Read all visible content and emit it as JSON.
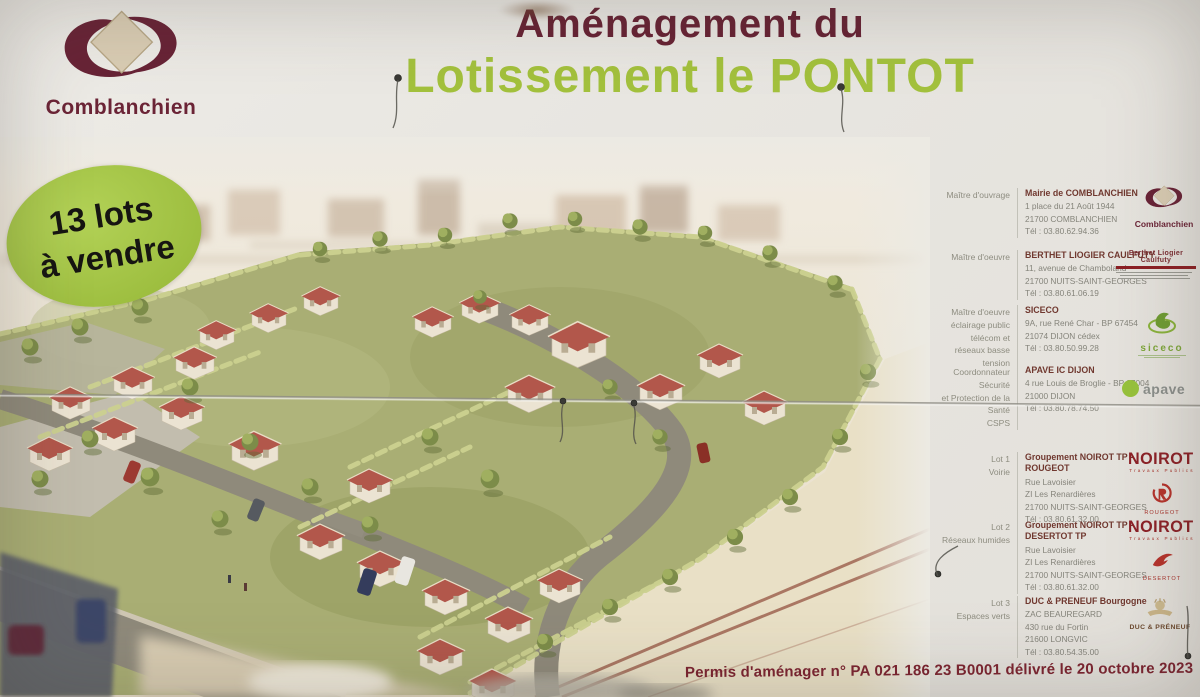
{
  "sign": {
    "title_line1": "Aménagement du",
    "title_line2": "Lotissement le PONTOT",
    "badge_line1": "13 lots",
    "badge_line2": "à vendre",
    "permit_line": "Permis d'aménager n° PA 021 186 23 B0001 délivré le 20 octobre 2023",
    "colors": {
      "title_maroon": "#672334",
      "title_green": "#a3c13d",
      "badge_green": "#a9c94e",
      "permit_red": "#7c2330",
      "noirot_red": "#8c2127",
      "siceco_green": "#7ea63a",
      "apave_green": "#97c23c"
    }
  },
  "logos": {
    "comblanchien": "Comblanchien",
    "comblanchien_small": "Comblanchien",
    "berthet": "Berthet Liogier Caulfuty",
    "siceco": "siceco",
    "apave": "apave",
    "noirot": "NOIROT",
    "noirot_sub": "Travaux Publics",
    "rougeot": "ROUGEOT",
    "desertot": "DESERTOT",
    "duc_preneuf": "DUC & PRÉNEUF"
  },
  "contacts": [
    {
      "role": "Maître d'ouvrage",
      "name": "Mairie de COMBLANCHIEN",
      "address": "1 place du 21 Août 1944\n21700 COMBLANCHIEN\nTél : 03.80.62.94.36"
    },
    {
      "role": "Maître d'oeuvre",
      "name": "BERTHET LIOGIER CAULFUTY",
      "address": "11, avenue de Chamboland\n21700 NUITS-SAINT-GEORGES\nTél : 03.80.61.06.19"
    },
    {
      "role": "Maître d'oeuvre\néclairage public\ntélécom et\nréseaux basse tension",
      "name": "SICECO",
      "address": "9A, rue René Char - BP 67454\n21074 DIJON cédex\nTél : 03.80.50.99.28"
    },
    {
      "role": "Coordonnateur Sécurité\net Protection de la Santé\nCSPS",
      "name": "APAVE IC DIJON",
      "address": "4 rue Louis de Broglie - BP 37004\n21000 DIJON\nTél : 03.80.78.74.50"
    },
    {
      "role": "Lot 1\nVoirie",
      "name": "Groupement NOIROT TP - ROUGEOT",
      "address": "Rue Lavoisier\nZI Les Renardières\n21700 NUITS-SAINT-GEORGES\nTél : 03.80.61.32.00"
    },
    {
      "role": "Lot 2\nRéseaux humides",
      "name": "Groupement NOIROT TP - DESERTOT TP",
      "address": "Rue Lavoisier\nZI Les Renardières\n21700 NUITS-SAINT-GEORGES\nTél : 03.80.61.32.00"
    },
    {
      "role": "Lot 3\nEspaces verts",
      "name": "DUC & PRENEUF Bourgogne",
      "address": "ZAC BEAUREGARD\n430 rue du Fortin\n21600 LONGVIC\nTél : 03.80.54.35.00"
    }
  ]
}
